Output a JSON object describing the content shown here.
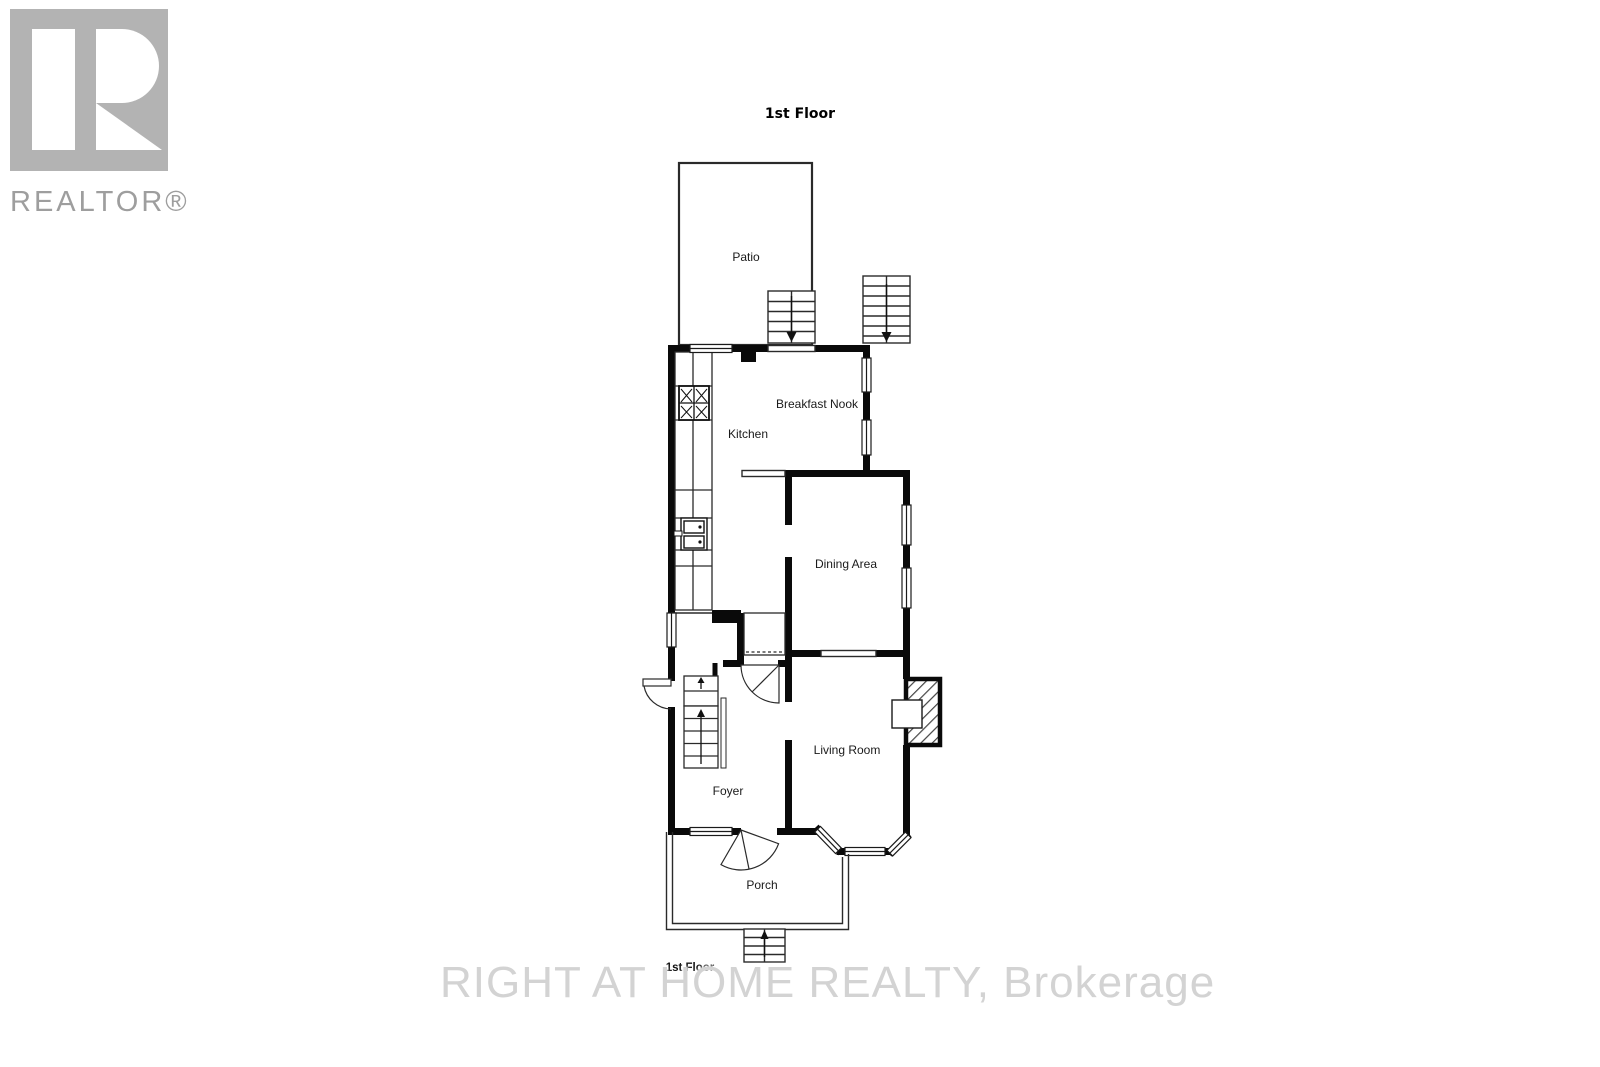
{
  "logo": {
    "brand": "REALTOR®"
  },
  "header": {
    "title": "1st Floor"
  },
  "floorplan": {
    "rooms": {
      "patio": "Patio",
      "breakfast_nook": "Breakfast Nook",
      "kitchen": "Kitchen",
      "dining": "Dining Area",
      "living": "Living Room",
      "foyer": "Foyer",
      "porch": "Porch"
    },
    "floor_label": "1st Floor"
  },
  "watermark": {
    "text": "RIGHT AT HOME REALTY, Brokerage"
  },
  "colors": {
    "wall": "#0a0a0a",
    "thin_line": "#2a2a2a",
    "label": "#1a1a1a",
    "logo_gray": "#b3b3b3",
    "logo_text": "#9e9e9e",
    "watermark": "#d3d3d3"
  }
}
